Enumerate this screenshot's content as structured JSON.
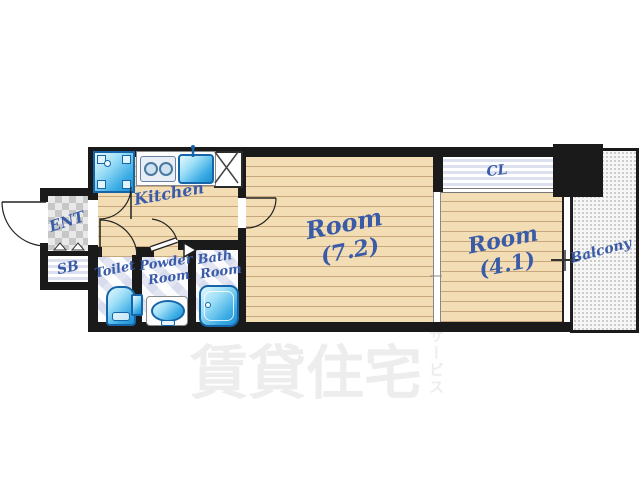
{
  "plan_title": "1K apartment floor plan",
  "palette": {
    "wall": "#1a1a1a",
    "wood_floor": "#f3ddb5",
    "plank_line": "#a47c4c",
    "label_blue": "#3a5ca8",
    "fixture_blue": "#38aae4",
    "fixture_border": "#1565a8",
    "water_room_bg": "#edeef7",
    "watermark_gray": "#ededed"
  },
  "rooms": {
    "entrance": {
      "label": "ENT"
    },
    "shoe_box": {
      "label": "SB"
    },
    "kitchen": {
      "label": "Kitchen"
    },
    "toilet": {
      "label": "Toilet"
    },
    "powder_room": {
      "label_line1": "Powder",
      "label_line2": "Room"
    },
    "bath_room": {
      "label_line1": "Bath",
      "label_line2": "Room"
    },
    "room_main": {
      "label": "Room",
      "size": "(7.2)"
    },
    "room_second": {
      "label": "Room",
      "size": "(4.1)"
    },
    "closet": {
      "label": "CL"
    },
    "balcony": {
      "label": "Balcony"
    }
  },
  "watermark": {
    "text": "賃貸住宅",
    "vertical_text": "サービス"
  }
}
